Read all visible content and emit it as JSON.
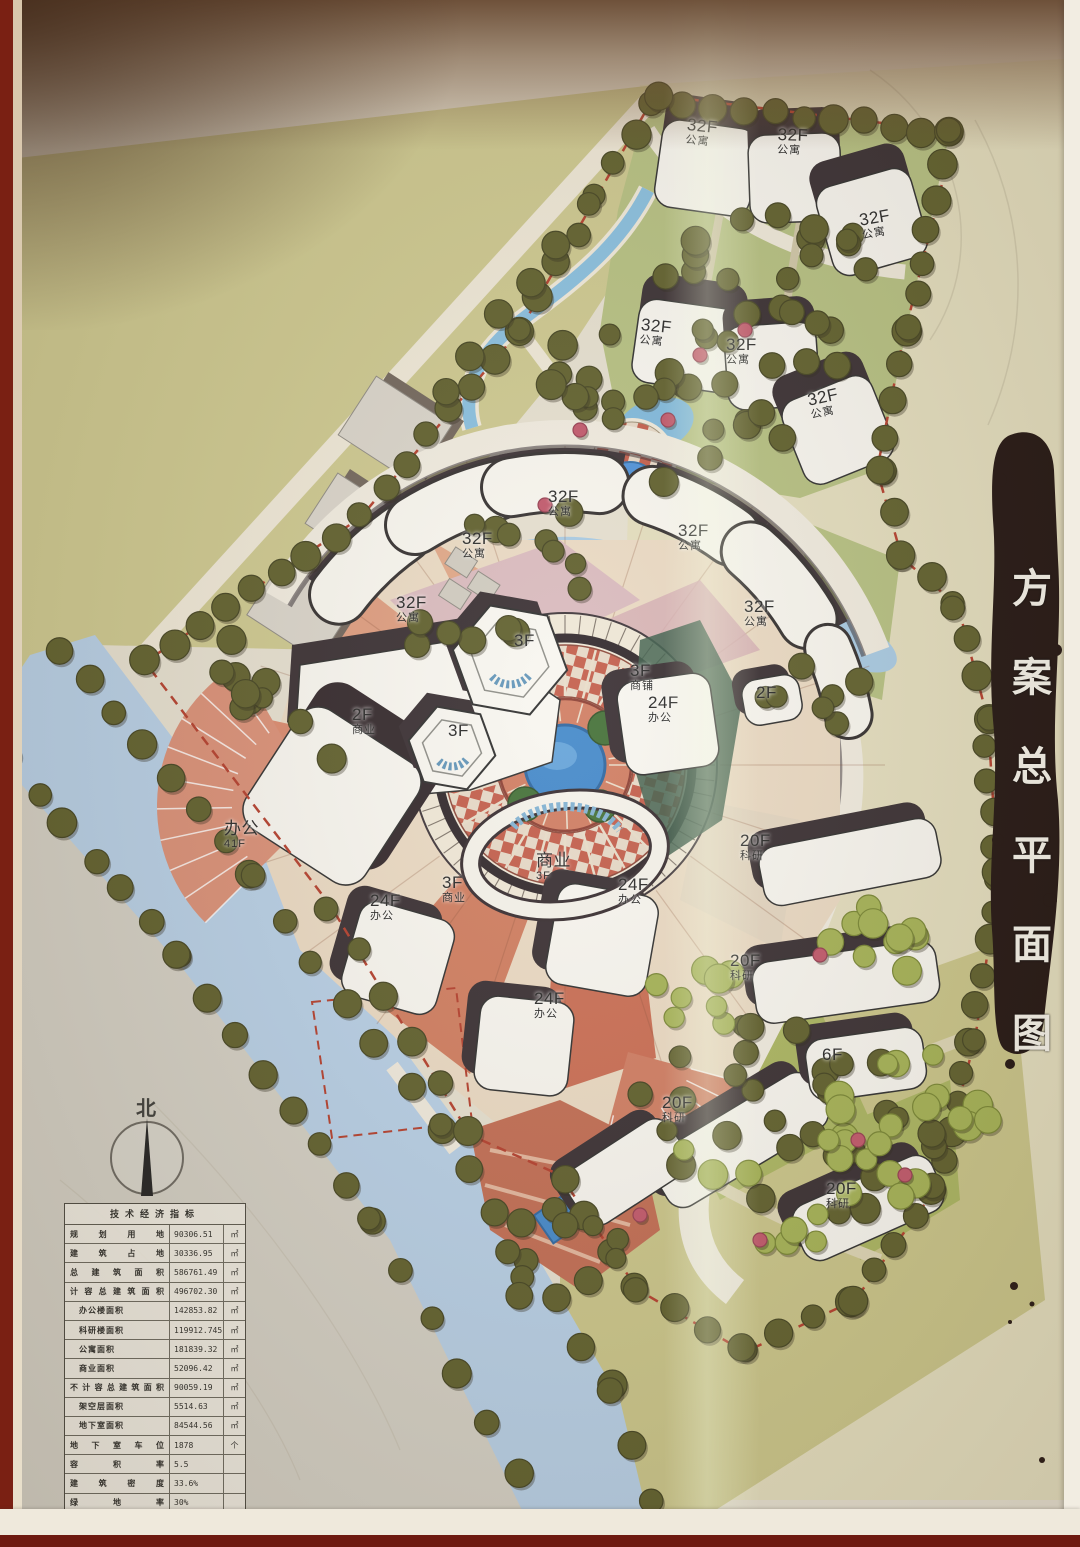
{
  "title_block": {
    "text": "方案总平面图",
    "chars": [
      "方",
      "案",
      "总",
      "平",
      "面",
      "图"
    ]
  },
  "north": {
    "label": "北"
  },
  "tec_table": {
    "title": "技术经济指标",
    "rows": [
      {
        "label": "规划用地",
        "value": "90306.51",
        "unit": "㎡",
        "indent": false
      },
      {
        "label": "建筑占地",
        "value": "30336.95",
        "unit": "㎡",
        "indent": false
      },
      {
        "label": "总建筑面积",
        "value": "586761.49",
        "unit": "㎡",
        "indent": false
      },
      {
        "label": "计容总建筑面积",
        "value": "496702.30",
        "unit": "㎡",
        "indent": false
      },
      {
        "label": "办公楼面积",
        "value": "142853.82",
        "unit": "㎡",
        "indent": true
      },
      {
        "label": "科研楼面积",
        "value": "119912.745",
        "unit": "㎡",
        "indent": true
      },
      {
        "label": "公寓面积",
        "value": "181839.32",
        "unit": "㎡",
        "indent": true
      },
      {
        "label": "商业面积",
        "value": "52096.42",
        "unit": "㎡",
        "indent": true
      },
      {
        "label": "不计容总建筑面积",
        "value": "90059.19",
        "unit": "㎡",
        "indent": false
      },
      {
        "label": "架空层面积",
        "value": "5514.63",
        "unit": "㎡",
        "indent": true
      },
      {
        "label": "地下室面积",
        "value": "84544.56",
        "unit": "㎡",
        "indent": true
      },
      {
        "label": "地下室车位",
        "value": "1878",
        "unit": "个",
        "indent": false
      },
      {
        "label": "容积率",
        "value": "5.5",
        "unit": "",
        "indent": false
      },
      {
        "label": "建筑密度",
        "value": "33.6%",
        "unit": "",
        "indent": false
      },
      {
        "label": "绿地率",
        "value": "30%",
        "unit": "",
        "indent": false
      }
    ]
  },
  "building_labels": [
    {
      "line1": "32F",
      "line2": "公寓",
      "x": 688,
      "y": 116,
      "rot": 6
    },
    {
      "line1": "32F",
      "line2": "公寓",
      "x": 778,
      "y": 126,
      "rot": 2
    },
    {
      "line1": "32F",
      "line2": "公寓",
      "x": 858,
      "y": 212,
      "rot": -10
    },
    {
      "line1": "32F",
      "line2": "公寓",
      "x": 642,
      "y": 316,
      "rot": 6
    },
    {
      "line1": "32F",
      "line2": "公寓",
      "x": 726,
      "y": 336,
      "rot": 0
    },
    {
      "line1": "32F",
      "line2": "公寓",
      "x": 806,
      "y": 392,
      "rot": -12
    },
    {
      "line1": "32F",
      "line2": "公寓",
      "x": 548,
      "y": 488,
      "rot": 0
    },
    {
      "line1": "32F",
      "line2": "公寓",
      "x": 462,
      "y": 530,
      "rot": 0
    },
    {
      "line1": "32F",
      "line2": "公寓",
      "x": 678,
      "y": 522,
      "rot": 0
    },
    {
      "line1": "32F",
      "line2": "公寓",
      "x": 396,
      "y": 594,
      "rot": 0
    },
    {
      "line1": "32F",
      "line2": "公寓",
      "x": 744,
      "y": 598,
      "rot": 0
    },
    {
      "line1": "3F",
      "line2": "",
      "x": 514,
      "y": 632,
      "rot": 0
    },
    {
      "line1": "3F",
      "line2": "商铺",
      "x": 630,
      "y": 662,
      "rot": 0
    },
    {
      "line1": "24F",
      "line2": "办公",
      "x": 648,
      "y": 694,
      "rot": 0
    },
    {
      "line1": "2F",
      "line2": "",
      "x": 756,
      "y": 684,
      "rot": 0
    },
    {
      "line1": "2F",
      "line2": "商业",
      "x": 352,
      "y": 706,
      "rot": 0
    },
    {
      "line1": "3F",
      "line2": "",
      "x": 448,
      "y": 722,
      "rot": 0
    },
    {
      "line1": "办公",
      "line2": "41F",
      "x": 224,
      "y": 820,
      "rot": 0
    },
    {
      "line1": "商业",
      "line2": "3F",
      "x": 536,
      "y": 852,
      "rot": 0
    },
    {
      "line1": "3F",
      "line2": "商业",
      "x": 442,
      "y": 874,
      "rot": 0
    },
    {
      "line1": "24F",
      "line2": "办公",
      "x": 618,
      "y": 876,
      "rot": 0
    },
    {
      "line1": "24F",
      "line2": "办公",
      "x": 370,
      "y": 892,
      "rot": 0
    },
    {
      "line1": "24F",
      "line2": "办公",
      "x": 534,
      "y": 990,
      "rot": 0
    },
    {
      "line1": "20F",
      "line2": "科研",
      "x": 740,
      "y": 832,
      "rot": 0
    },
    {
      "line1": "20F",
      "line2": "科研",
      "x": 730,
      "y": 952,
      "rot": 0
    },
    {
      "line1": "6F",
      "line2": "",
      "x": 822,
      "y": 1046,
      "rot": 0
    },
    {
      "line1": "20F",
      "line2": "科研",
      "x": 662,
      "y": 1094,
      "rot": 0
    },
    {
      "line1": "20F",
      "line2": "科研",
      "x": 826,
      "y": 1180,
      "rot": 0
    }
  ],
  "colors": {
    "paper": "#e6e0d0",
    "ink_brush": "#1d0f0c",
    "water": "#b5cee6",
    "canal": "#a6c9e3",
    "tree_dark": "#5c5c28",
    "tree_light": "#a3b152",
    "brick": "#c25a47",
    "lawn": "#b4bf7f",
    "building": "#f8f6ef",
    "shadow": "#342a2e",
    "boundary_dash": "#b23a28"
  }
}
